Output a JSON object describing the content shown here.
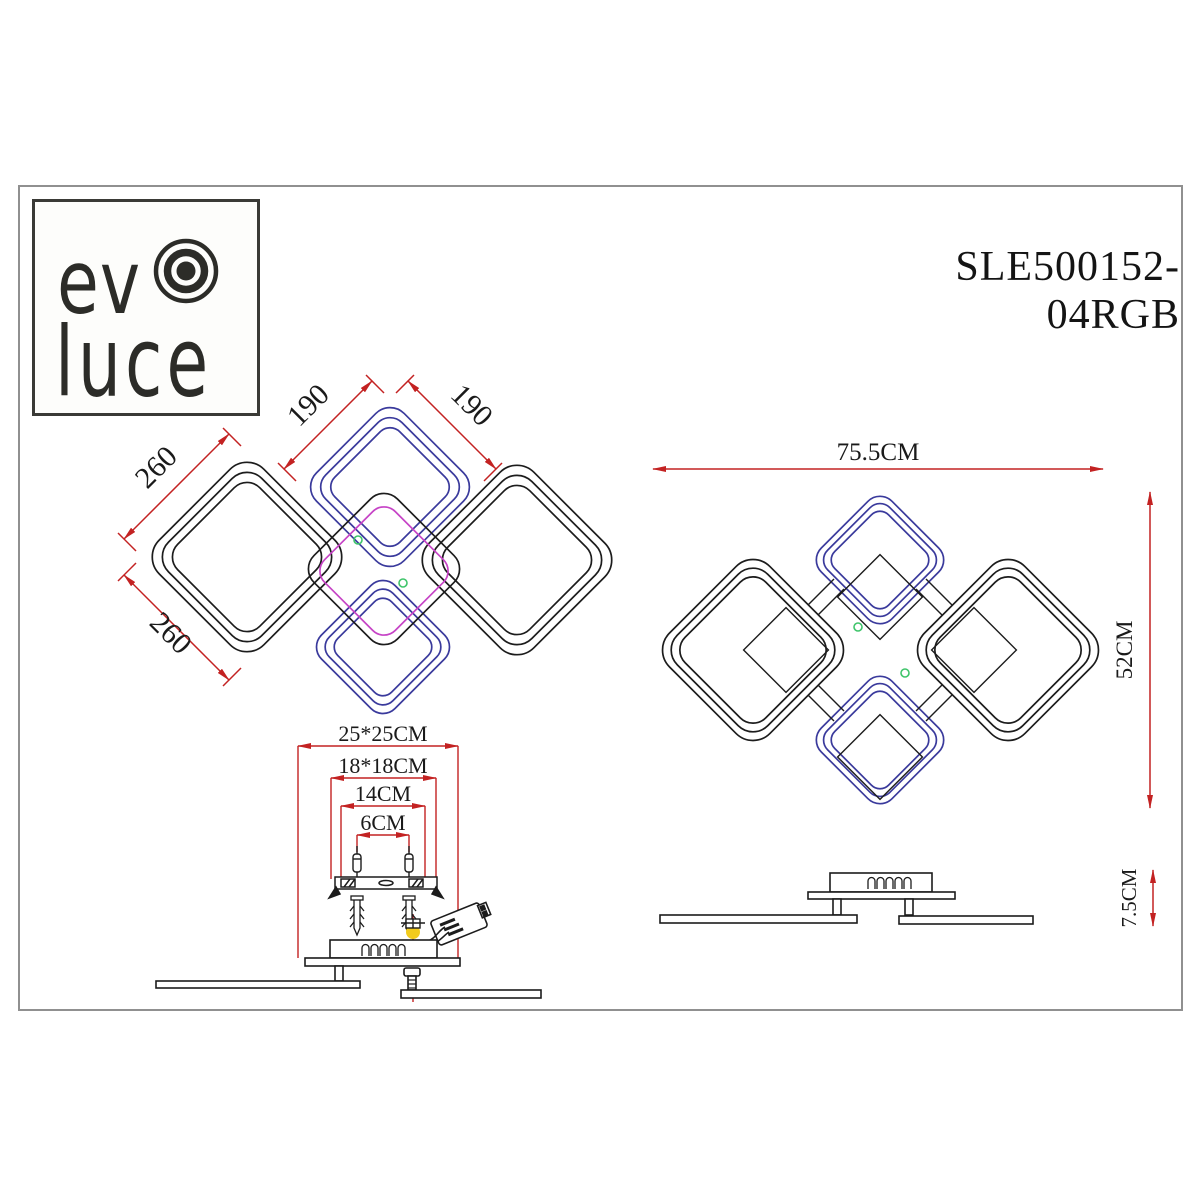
{
  "brand": {
    "logo_top": "ev",
    "logo_bottom": "luce"
  },
  "model_number": "SLE500152-04RGB",
  "front_view": {
    "dim_top_left": "190",
    "dim_top_right": "190",
    "dim_left_upper": "260",
    "dim_left_lower": "260"
  },
  "plan_view": {
    "dim_width": "75.5CM",
    "dim_height": "52CM"
  },
  "mounting_view": {
    "dim_outer": "25*25CM",
    "dim_bracket": "18*18CM",
    "dim_holes": "14CM",
    "dim_screws": "6CM"
  },
  "side_view": {
    "dim_height": "7.5CM"
  },
  "colors": {
    "dimension_red": "#c32222",
    "ring_blue": "#3a3a9c",
    "ring_magenta": "#c643c6",
    "marker_green": "#3ec46a",
    "highlight_yellow": "#f2cb1d",
    "line_black": "#1c1c1c",
    "frame_gray": "#909090"
  }
}
